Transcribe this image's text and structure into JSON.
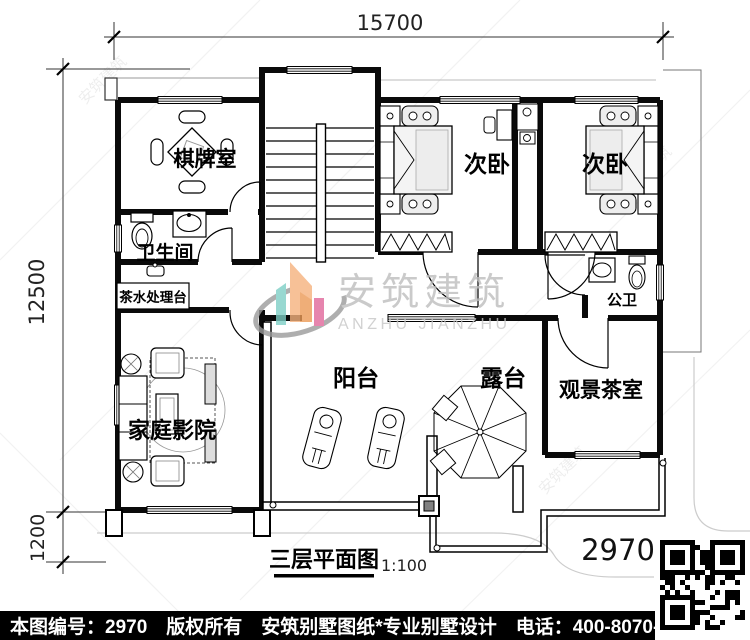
{
  "dimensions": {
    "width_top": "15700",
    "height_left": "12500",
    "height_bottom_left": "1200"
  },
  "rooms": {
    "chess_room": "棋牌室",
    "bathroom": "卫生间",
    "tea_station": "茶水处理台",
    "bedroom_left": "次卧",
    "bedroom_right": "次卧",
    "public_wc": "公卫",
    "home_theater": "家庭影院",
    "balcony": "阳台",
    "terrace": "露台",
    "view_tea_room": "观景茶室"
  },
  "title_block": {
    "title": "三层平面图",
    "scale": "1:100",
    "plan_number": "2970"
  },
  "watermark": {
    "brand": "安筑建筑",
    "brand_en": "ANZHU JIANZHU"
  },
  "footer": {
    "plan_no": "本图编号：2970",
    "copyright": "版权所有",
    "brand": "安筑别墅图纸*专业别墅设计",
    "phone": "电话：400-8070-511",
    "qr_hint": "扫码看图"
  },
  "colors": {
    "teal": "#7ECFC6",
    "orange": "#F6B27E",
    "orange_dark": "#EC9A57",
    "pink": "#E0679B",
    "swoosh_gray": "#9A9A9A",
    "watermark_text": "#BDBDBD",
    "bar_bg": "#000000",
    "bar_text": "#FFFFFF"
  }
}
